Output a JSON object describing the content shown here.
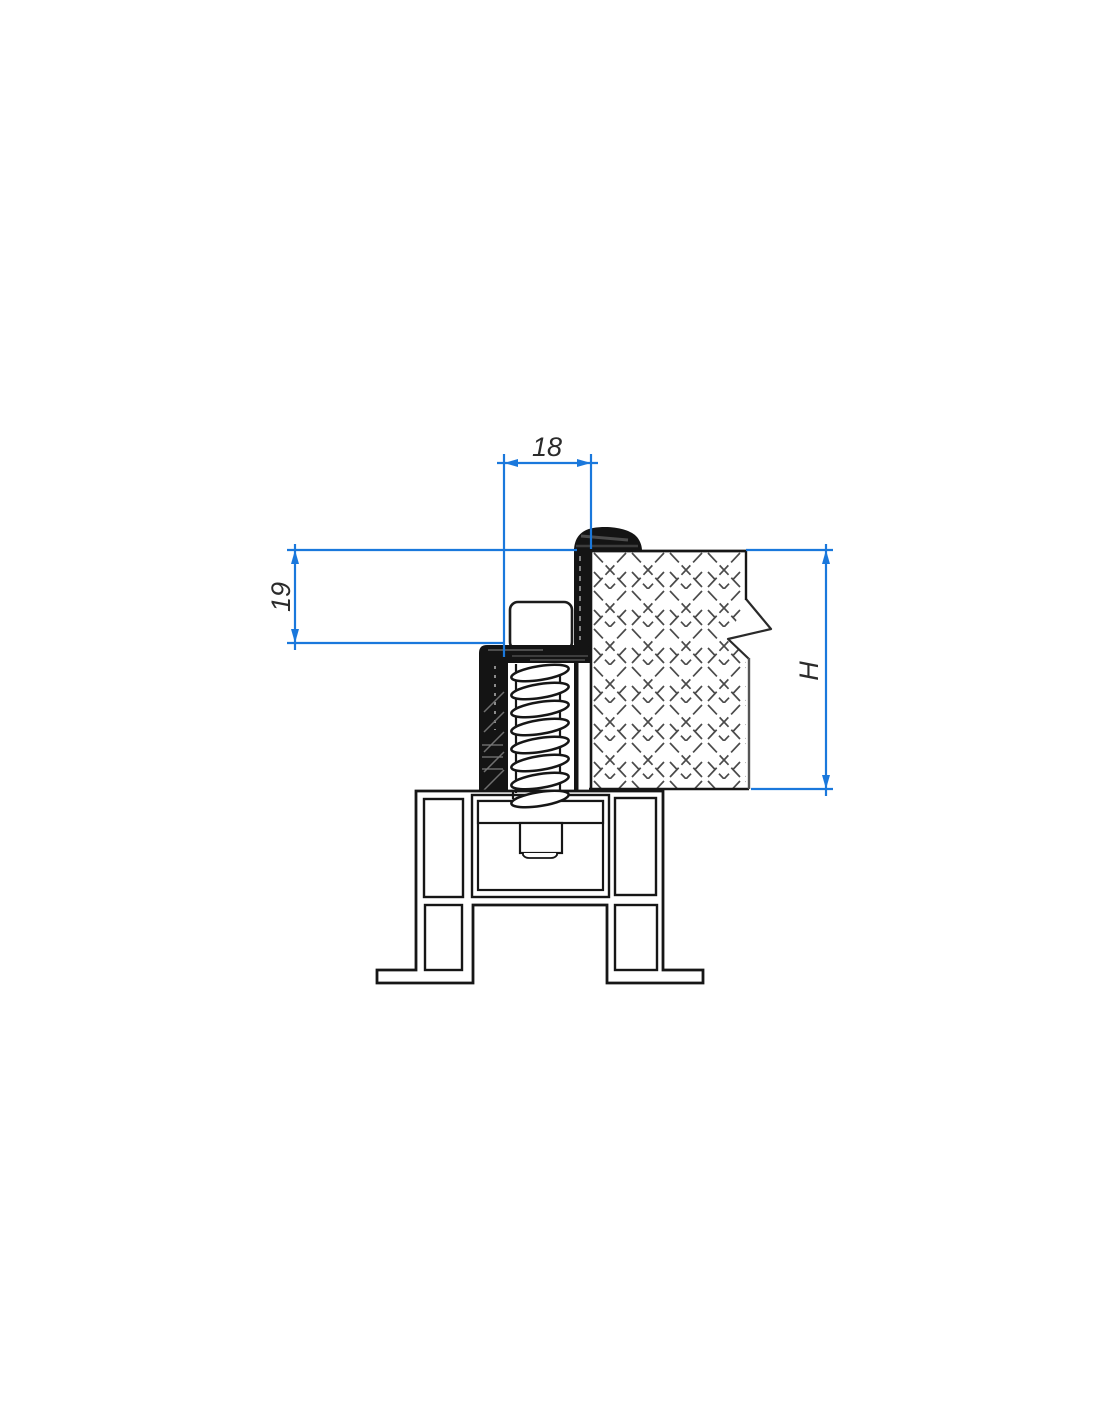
{
  "drawing": {
    "kind": "technical-cross-section",
    "background_color": "#ffffff",
    "dimension_color": "#1a78dc",
    "outline_color": "#161616",
    "seal_fill_color": "#141414",
    "hatch_color": "#4a4a4a"
  },
  "dimensions": {
    "gap_width": {
      "label": "18"
    },
    "seal_height": {
      "label": "19"
    },
    "panel_height": {
      "label": "H"
    }
  }
}
